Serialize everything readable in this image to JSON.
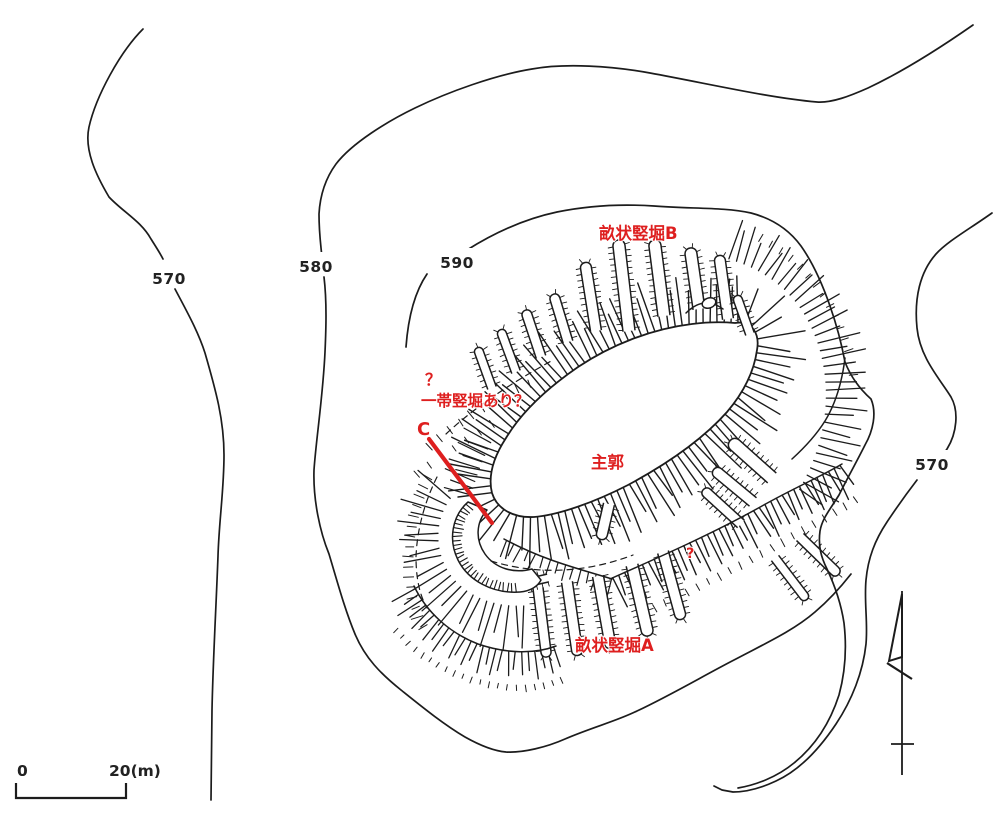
{
  "annotations": {
    "tatebori_b": {
      "text": "畝状竪堀B"
    },
    "question_nw": {
      "text": "？"
    },
    "belt_note": {
      "text": "一帯竪堀あり？"
    },
    "section_c": {
      "text": "C"
    },
    "main_bailey": {
      "text": "主郭"
    },
    "question_se": {
      "text": "?"
    },
    "tatebori_a": {
      "text": "畝状竪堀A"
    }
  },
  "contour_labels": {
    "left_570": "570",
    "mid_580": "580",
    "mid_590": "590",
    "right_570": "570"
  },
  "scale_bar": {
    "start": "0",
    "end": "20(m)"
  },
  "colors": {
    "annotation_red": "#de1f1f",
    "ink": "#1c1c1c",
    "paper": "#ffffff"
  }
}
